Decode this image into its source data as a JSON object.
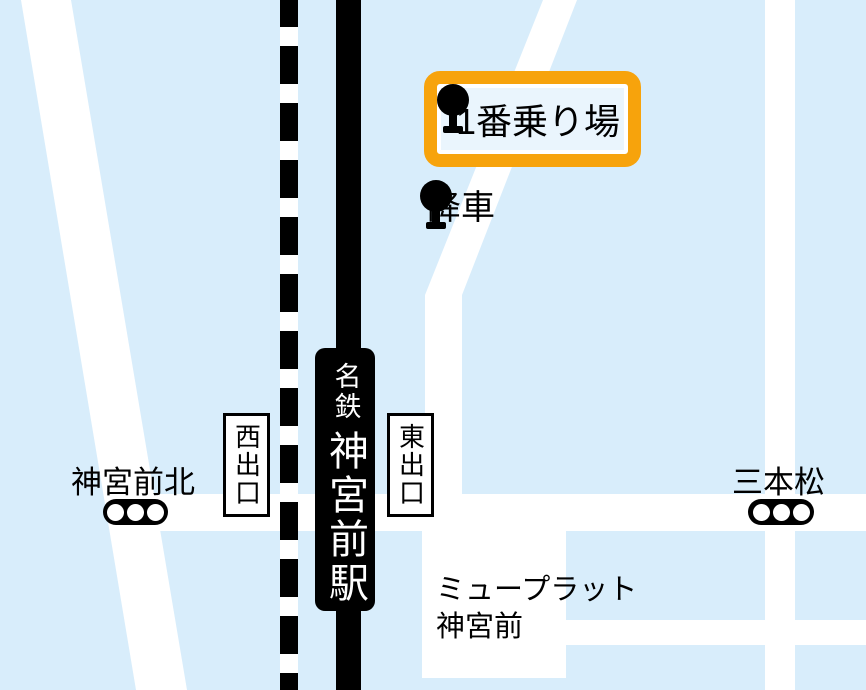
{
  "colors": {
    "map_background": "#d8edfb",
    "road": "#ffffff",
    "highlight_orange": "#f7a30c",
    "highlight_fill": "#eaf5fd",
    "ink": "#000000"
  },
  "station_sign": {
    "operator": "名鉄",
    "name": "神宮前駅"
  },
  "bus_stops": {
    "boarding": {
      "label": "1番乗り場"
    },
    "alighting": {
      "label": "降車"
    }
  },
  "exits": {
    "west": {
      "label": "西出口"
    },
    "east": {
      "label": "東出口"
    }
  },
  "intersections": {
    "jingumae_kita": {
      "label": "神宮前北"
    },
    "sanbonmatsu": {
      "label": "三本松"
    }
  },
  "building": {
    "name_line1": "ミュープラット",
    "name_line2": "神宮前"
  }
}
